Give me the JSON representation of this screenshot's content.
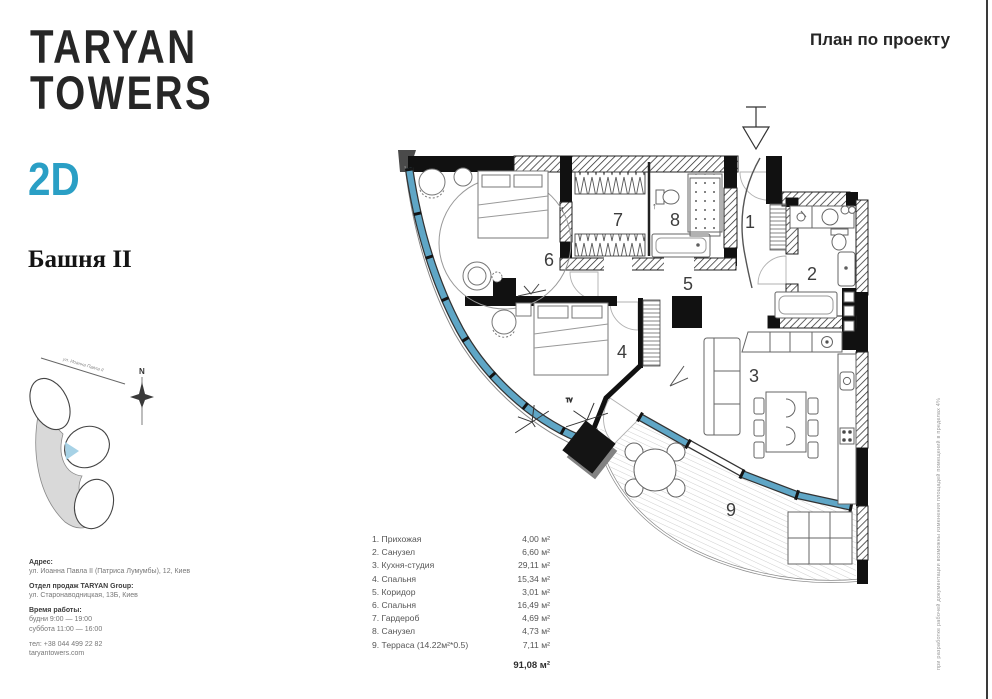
{
  "brand": {
    "line1": "TARYAN",
    "line2": "TOWERS",
    "view": "2D",
    "tower": "Башня II"
  },
  "header": {
    "plan_title": "План по проекту"
  },
  "map": {
    "north": "N",
    "street": "ул. Иоанна Павла II"
  },
  "contact": {
    "address_label": "Адрес:",
    "address": "ул. Иоанна Павла II (Патриса Лумумбы), 12, Киев",
    "sales_label": "Отдел продаж TARYAN Group:",
    "sales_address": "ул. Старонаводницкая, 13Б, Киев",
    "hours_label": "Время работы:",
    "hours_weekdays": "будни 9:00 — 19:00",
    "hours_saturday": "суббота 11:00 — 16:00",
    "phone": "тел: +38 044 499 22 82",
    "website": "taryantowers.com"
  },
  "legend": {
    "rooms": [
      {
        "label": "1. Прихожая",
        "area": "4,00 м²"
      },
      {
        "label": "2. Санузел",
        "area": "6,60 м²"
      },
      {
        "label": "3. Кухня-студия",
        "area": "29,11 м²"
      },
      {
        "label": "4. Спальня",
        "area": "15,34 м²"
      },
      {
        "label": "5. Коридор",
        "area": "3,01 м²"
      },
      {
        "label": "6. Спальня",
        "area": "16,49 м²"
      },
      {
        "label": "7. Гардероб",
        "area": "4,69 м²"
      },
      {
        "label": "8. Санузел",
        "area": "4,73 м²"
      },
      {
        "label": "9. Терраса (14.22м²*0.5)",
        "area": "7,11 м²"
      }
    ],
    "total": "91,08 м²"
  },
  "plan": {
    "room_numbers": [
      "1",
      "2",
      "3",
      "4",
      "5",
      "6",
      "7",
      "8",
      "9"
    ],
    "tv_mark": "TV"
  },
  "disclaimer": "при разработке рабочей документации возможны изменения площадей помещений в пределах 4%",
  "colors": {
    "accent_blue": "#2a9fc5",
    "glazing_blue": "#5fa6c6",
    "ink": "#262626"
  }
}
